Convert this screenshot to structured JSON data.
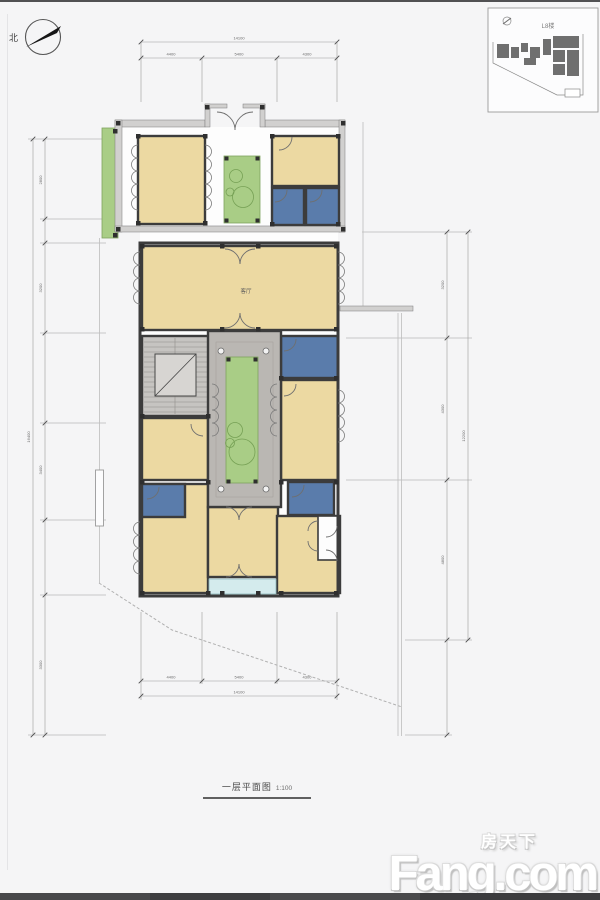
{
  "compass": {
    "north_label": "北"
  },
  "site_map": {
    "label": "L8楼"
  },
  "plan": {
    "hall_label": "客厅"
  },
  "dims": {
    "top": {
      "overall": "14100",
      "seg": [
        "4400",
        "5400",
        "4300"
      ]
    },
    "bottom": {
      "overall": "14100",
      "seg": [
        "4400",
        "5400",
        "4300"
      ]
    },
    "left": {
      "overall": "16400",
      "seg": [
        "2800",
        "3200",
        "3400",
        "3300"
      ]
    },
    "right": {
      "overall": "12200",
      "seg": [
        "3200",
        "4300",
        "4800"
      ]
    }
  },
  "caption": {
    "title": "一层平面图",
    "scale": "1:100"
  },
  "brand": {
    "cn": "房天下",
    "en": "Fang.com"
  }
}
